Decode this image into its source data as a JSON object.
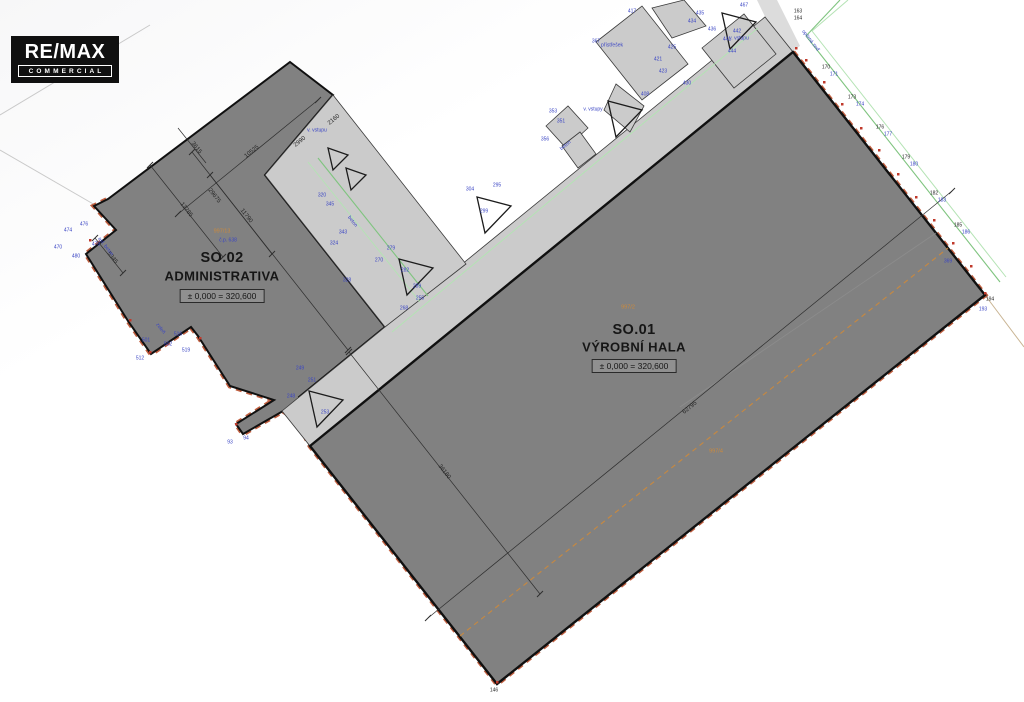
{
  "logo": {
    "line1": "RE/MAX",
    "line2": "COMMERCIAL"
  },
  "buildings": [
    {
      "id": "SO.01",
      "name": "VÝROBNÍ HALA",
      "elevation": "± 0,000 = 320,600",
      "parcel": "997/2"
    },
    {
      "id": "SO.02",
      "name": "ADMINISTRATIVA",
      "elevation": "± 0,000 = 320,600",
      "parcel": "997/13",
      "house_no": "č.p. 638"
    }
  ],
  "colors": {
    "hall-fill": "#818181",
    "canopy-fill": "#cbcbcb",
    "boundary-red": "#bb5130",
    "fence-green": "#7fc47f",
    "ann-blue": "#3a45c4",
    "parcel-orange": "#cf8a3a"
  },
  "dimensions": [
    {
      "t": "62795",
      "x": 690,
      "y": 408,
      "r": -39
    },
    {
      "t": "36180",
      "x": 444,
      "y": 472,
      "r": 52
    },
    {
      "t": "10525",
      "x": 252,
      "y": 152,
      "r": -39
    },
    {
      "t": "3615",
      "x": 196,
      "y": 148,
      "r": 52
    },
    {
      "t": "29675",
      "x": 214,
      "y": 196,
      "r": 52
    },
    {
      "t": "13785",
      "x": 186,
      "y": 210,
      "r": 52
    },
    {
      "t": "11790",
      "x": 246,
      "y": 216,
      "r": 52
    },
    {
      "t": "5345",
      "x": 112,
      "y": 258,
      "r": 52
    },
    {
      "t": "2990",
      "x": 300,
      "y": 142,
      "r": -39
    },
    {
      "t": "2160",
      "x": 334,
      "y": 120,
      "r": -39
    }
  ],
  "annotations": [
    {
      "t": "367",
      "x": 596,
      "y": 42
    },
    {
      "t": "417",
      "x": 632,
      "y": 12
    },
    {
      "t": "435",
      "x": 700,
      "y": 14
    },
    {
      "t": "434",
      "x": 692,
      "y": 22
    },
    {
      "t": "436",
      "x": 712,
      "y": 30
    },
    {
      "t": "441",
      "x": 727,
      "y": 40
    },
    {
      "t": "442",
      "x": 737,
      "y": 32
    },
    {
      "t": "444",
      "x": 732,
      "y": 52
    },
    {
      "t": "467",
      "x": 744,
      "y": 6
    },
    {
      "t": "421",
      "x": 658,
      "y": 60
    },
    {
      "t": "425",
      "x": 672,
      "y": 48
    },
    {
      "t": "423",
      "x": 663,
      "y": 72
    },
    {
      "t": "430",
      "x": 687,
      "y": 84
    },
    {
      "t": "408",
      "x": 645,
      "y": 95
    },
    {
      "t": "přístřešek",
      "x": 612,
      "y": 46
    },
    {
      "t": "v. vstupu",
      "x": 739,
      "y": 39
    },
    {
      "t": "v. vstupy",
      "x": 593,
      "y": 110
    },
    {
      "t": "beton",
      "x": 566,
      "y": 146,
      "r": -39
    },
    {
      "t": "353",
      "x": 553,
      "y": 112
    },
    {
      "t": "351",
      "x": 561,
      "y": 122
    },
    {
      "t": "356",
      "x": 545,
      "y": 140
    },
    {
      "t": "304",
      "x": 470,
      "y": 190
    },
    {
      "t": "299",
      "x": 484,
      "y": 212
    },
    {
      "t": "295",
      "x": 497,
      "y": 186
    },
    {
      "t": "279",
      "x": 391,
      "y": 249
    },
    {
      "t": "282",
      "x": 405,
      "y": 271
    },
    {
      "t": "270",
      "x": 379,
      "y": 261
    },
    {
      "t": "289",
      "x": 417,
      "y": 287
    },
    {
      "t": "beton",
      "x": 352,
      "y": 222,
      "r": 52
    },
    {
      "t": "320",
      "x": 322,
      "y": 196
    },
    {
      "t": "324",
      "x": 334,
      "y": 244
    },
    {
      "t": "328",
      "x": 347,
      "y": 281
    },
    {
      "t": "345",
      "x": 330,
      "y": 205
    },
    {
      "t": "343",
      "x": 343,
      "y": 233
    },
    {
      "t": "249",
      "x": 300,
      "y": 369
    },
    {
      "t": "251",
      "x": 312,
      "y": 381
    },
    {
      "t": "248",
      "x": 291,
      "y": 397
    },
    {
      "t": "253",
      "x": 325,
      "y": 413
    },
    {
      "t": "268",
      "x": 404,
      "y": 309
    },
    {
      "t": "255",
      "x": 420,
      "y": 299
    },
    {
      "t": "v. vstupu",
      "x": 317,
      "y": 131
    },
    {
      "t": "474",
      "x": 68,
      "y": 231
    },
    {
      "t": "476",
      "x": 84,
      "y": 225
    },
    {
      "t": "478",
      "x": 96,
      "y": 245
    },
    {
      "t": "480",
      "x": 76,
      "y": 257
    },
    {
      "t": "470",
      "x": 58,
      "y": 248
    },
    {
      "t": "asf. beton",
      "x": 105,
      "y": 247,
      "r": 52
    },
    {
      "t": "zeleň",
      "x": 160,
      "y": 329,
      "r": 52
    },
    {
      "t": "501",
      "x": 146,
      "y": 341
    },
    {
      "t": "502",
      "x": 168,
      "y": 345
    },
    {
      "t": "516",
      "x": 178,
      "y": 335
    },
    {
      "t": "519",
      "x": 186,
      "y": 351
    },
    {
      "t": "512",
      "x": 140,
      "y": 359
    },
    {
      "t": "93",
      "x": 230,
      "y": 443
    },
    {
      "t": "94",
      "x": 246,
      "y": 439
    },
    {
      "t": "opěrná zeď",
      "x": 810,
      "y": 41,
      "r": 52
    },
    {
      "t": "163",
      "x": 798,
      "y": 12,
      "c": "k"
    },
    {
      "t": "164",
      "x": 798,
      "y": 19,
      "c": "k"
    },
    {
      "t": "170",
      "x": 826,
      "y": 68,
      "c": "k"
    },
    {
      "t": "171",
      "x": 834,
      "y": 75
    },
    {
      "t": "173",
      "x": 852,
      "y": 98,
      "c": "k"
    },
    {
      "t": "174",
      "x": 860,
      "y": 105
    },
    {
      "t": "176",
      "x": 880,
      "y": 128,
      "c": "k"
    },
    {
      "t": "177",
      "x": 888,
      "y": 135
    },
    {
      "t": "179",
      "x": 906,
      "y": 158,
      "c": "k"
    },
    {
      "t": "180",
      "x": 914,
      "y": 165
    },
    {
      "t": "182",
      "x": 934,
      "y": 194,
      "c": "k"
    },
    {
      "t": "183",
      "x": 942,
      "y": 201
    },
    {
      "t": "185",
      "x": 958,
      "y": 226,
      "c": "k"
    },
    {
      "t": "186",
      "x": 966,
      "y": 233
    },
    {
      "t": "194",
      "x": 990,
      "y": 300,
      "c": "k"
    },
    {
      "t": "193",
      "x": 983,
      "y": 310
    },
    {
      "t": "369",
      "x": 948,
      "y": 262
    },
    {
      "t": "146",
      "x": 494,
      "y": 691,
      "c": "k"
    },
    {
      "t": "č.p. 638",
      "x": 228,
      "y": 241
    },
    {
      "t": "997/13",
      "x": 222,
      "y": 232,
      "c": "o"
    },
    {
      "t": "997/2",
      "x": 628,
      "y": 308,
      "c": "o"
    },
    {
      "t": "997/4",
      "x": 716,
      "y": 452,
      "c": "o"
    }
  ]
}
